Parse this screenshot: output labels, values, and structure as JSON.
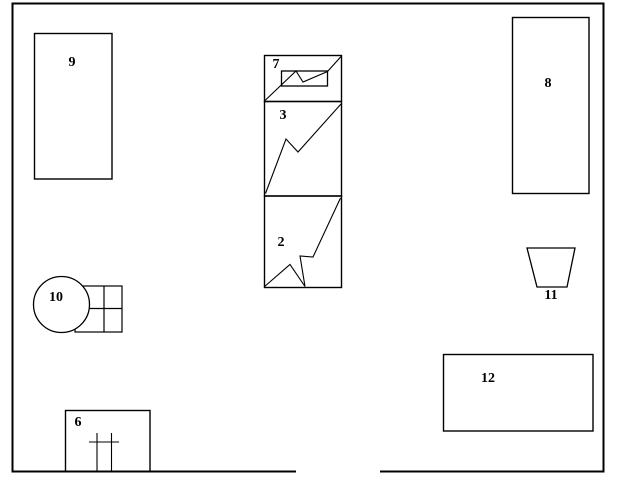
{
  "diagram": {
    "title": "floor-plan-schematic",
    "stroke_color": "#000000",
    "background_color": "#ffffff",
    "labels": {
      "n2": "2",
      "n3": "3",
      "n6": "6",
      "n7": "7",
      "n8": "8",
      "n9": "9",
      "n10": "10",
      "n11": "11",
      "n12": "12"
    }
  }
}
